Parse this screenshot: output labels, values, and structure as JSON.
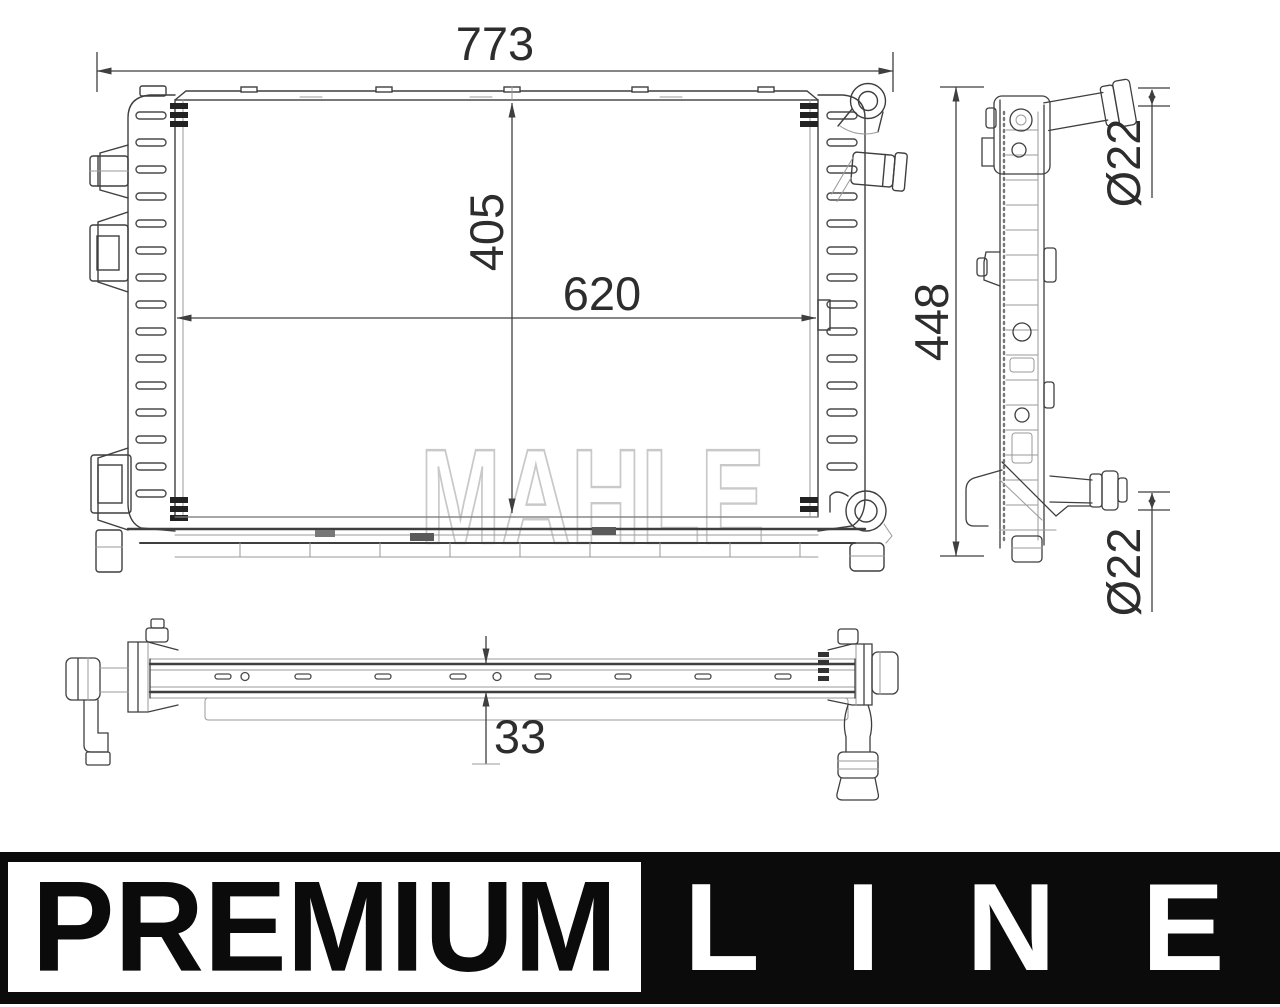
{
  "drawing": {
    "watermark": "MAHLE",
    "front_view": {
      "overall_width": "773",
      "core_height": "405",
      "core_width": "620"
    },
    "side_view": {
      "overall_height": "448",
      "top_port_diameter": "Ø22",
      "bottom_port_diameter": "Ø22"
    },
    "bottom_view": {
      "thickness": "33"
    }
  },
  "banner": {
    "premium": "PREMIUM",
    "line": "LINE"
  },
  "colors": {
    "line_dark": "#3f3f3f",
    "line_light": "#9a9a9a",
    "watermark": "#c9c9c9",
    "banner_bg": "#0b0b0b",
    "banner_text": "#ffffff"
  }
}
